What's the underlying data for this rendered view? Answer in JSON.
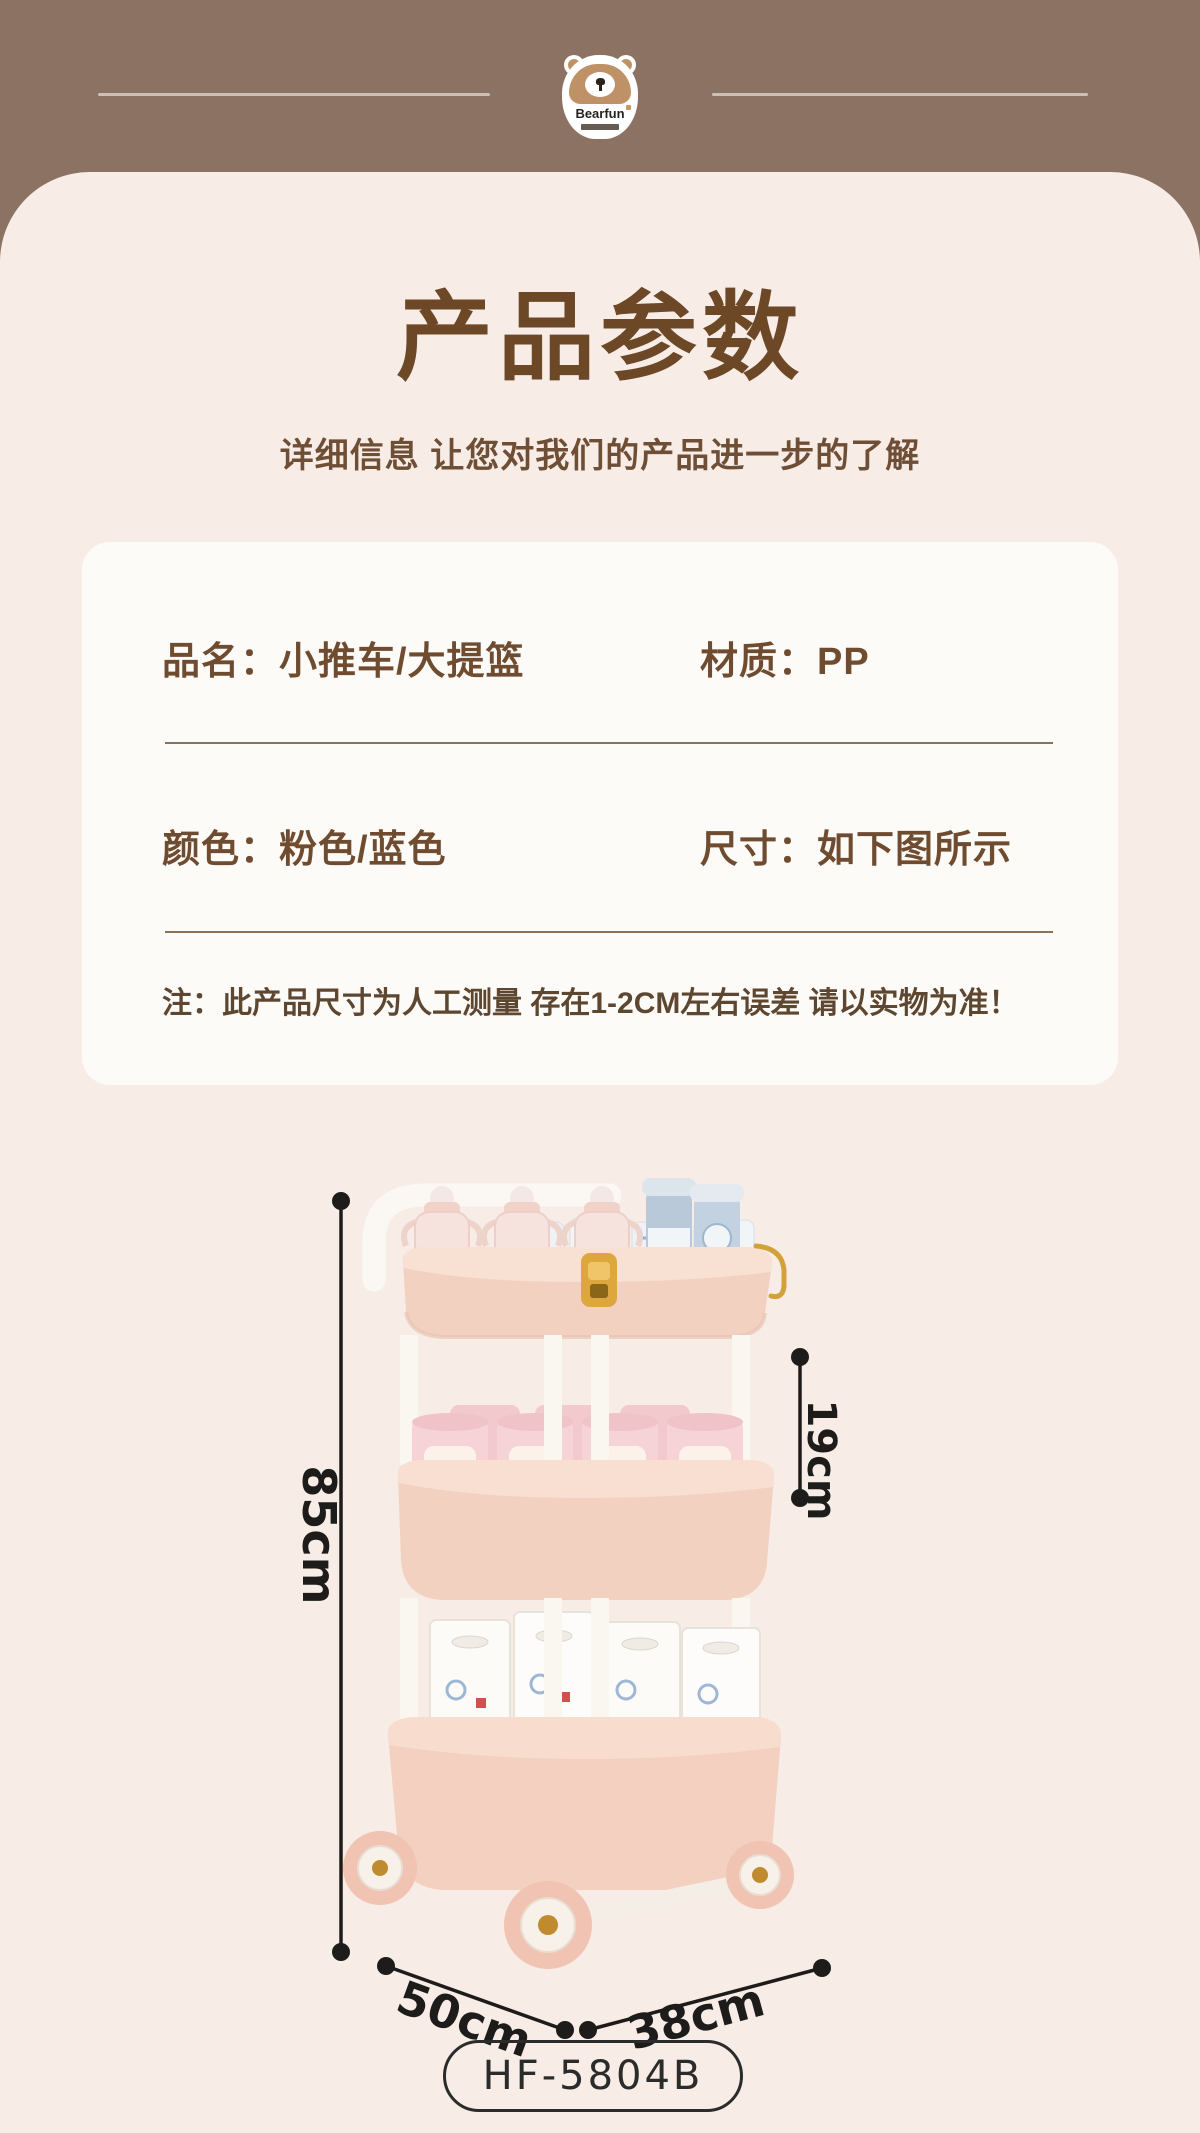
{
  "header": {
    "logo": {
      "brand": "Bearfun",
      "registered": "®"
    }
  },
  "hero": {
    "title": "产品参数",
    "subtitle": "详细信息 让您对我们的产品进一步的了解"
  },
  "spec_card": {
    "rows": [
      {
        "left": "品名：小推车/大提篮",
        "right": "材质：PP"
      },
      {
        "left": "颜色：粉色/蓝色",
        "right": "尺寸：如下图所示"
      }
    ],
    "note": "注：此产品尺寸为人工测量 存在1-2CM左右误差 请以实物为准！"
  },
  "diagram": {
    "height_label": "85cm",
    "tier_label": "19cm",
    "depth_label": "50cm",
    "width_label": "38cm"
  },
  "model_badge": "HF-5804B",
  "colors": {
    "header_bg": "#8b7262",
    "header_line": "#cdc1b7",
    "panel_bg": "#f7ece6",
    "card_bg": "#fdfbf8",
    "title_text": "#6d4827",
    "spec_text": "#6f4c30",
    "divider": "#8a7254",
    "dimension_ink": "#1d1c1a",
    "cart_pink": "#f3d1c1",
    "can_pink": "#f6d3d6",
    "gold": "#d9a43b",
    "bear_tan": "#bf9166"
  }
}
